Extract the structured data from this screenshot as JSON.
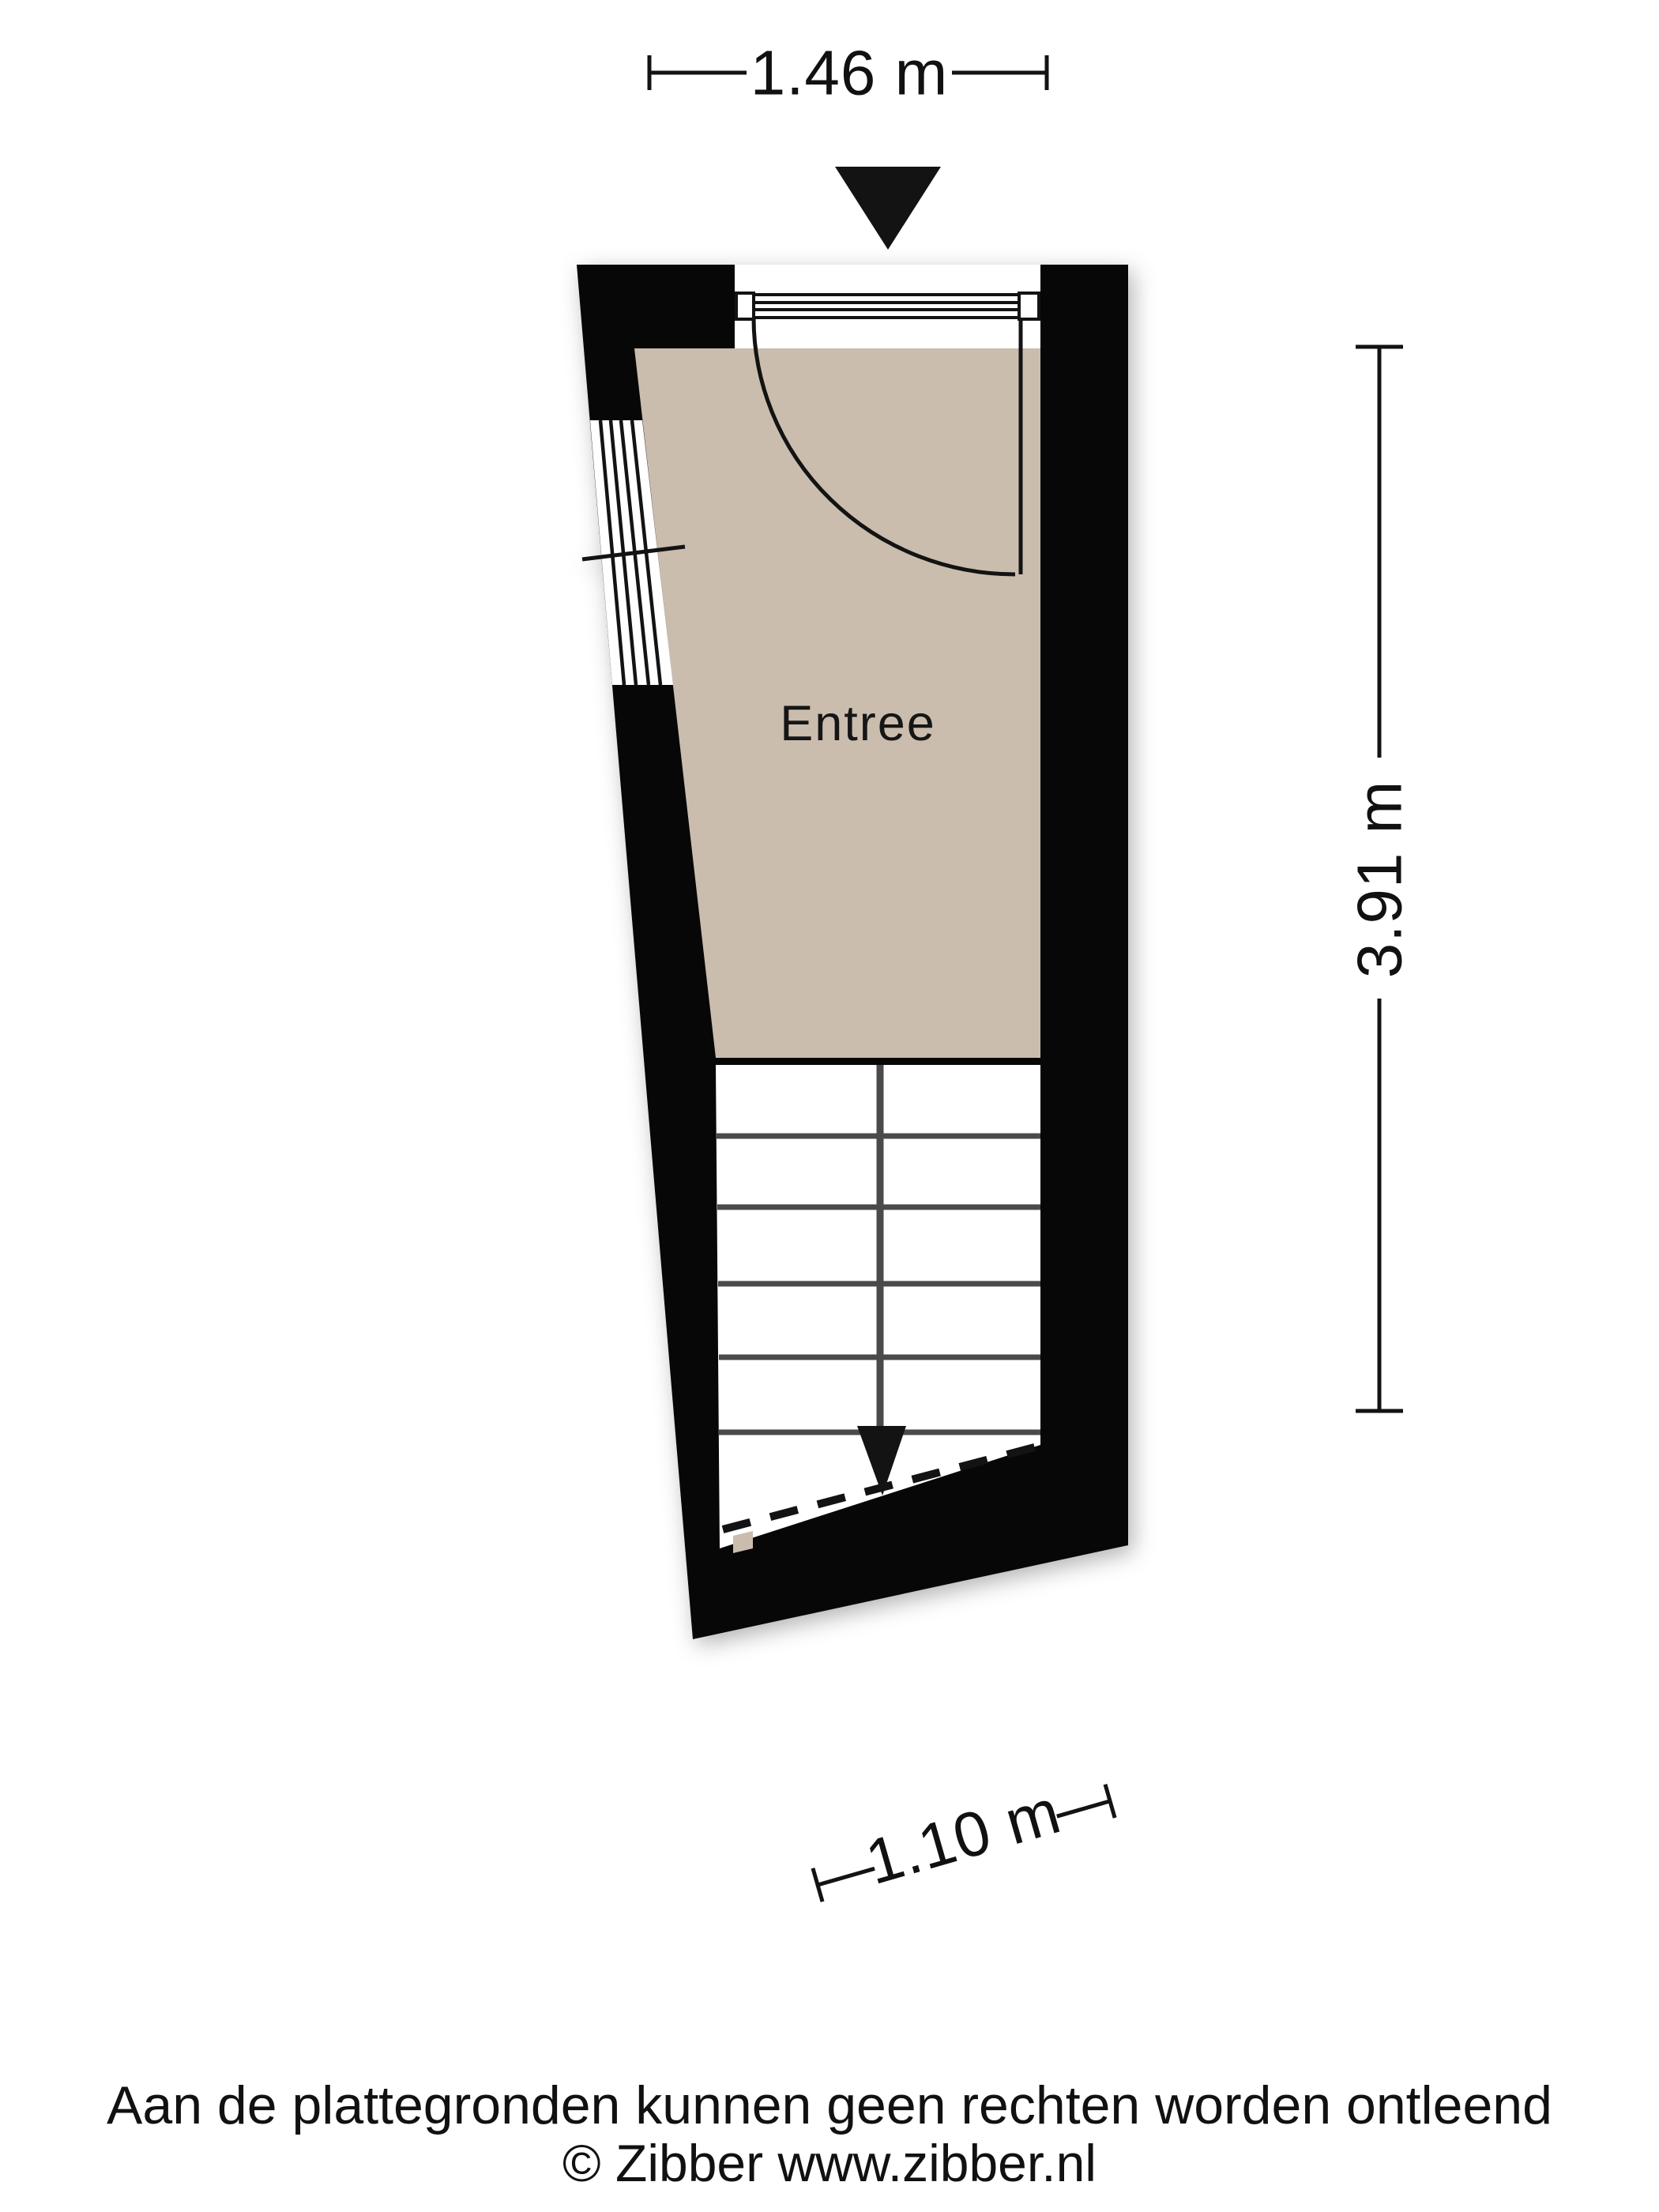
{
  "room": {
    "label": "Entree"
  },
  "dimensions": {
    "width_top": "1.46 m",
    "height_right": "3.91 m",
    "width_bottom": "1.10 m"
  },
  "footer": {
    "disclaimer": "Aan de plattegronden kunnen geen rechten worden ontleend",
    "copyright": "© Zibber www.zibber.nl"
  },
  "colors": {
    "floor": "#cabdae",
    "wall": "#070707",
    "ink": "#131313",
    "stair_line": "#4a4a4a",
    "background": "#ffffff"
  },
  "icons": {
    "entrance_arrow": "filled-triangle-down",
    "stairs_down_arrow": "filled-triangle-down"
  }
}
